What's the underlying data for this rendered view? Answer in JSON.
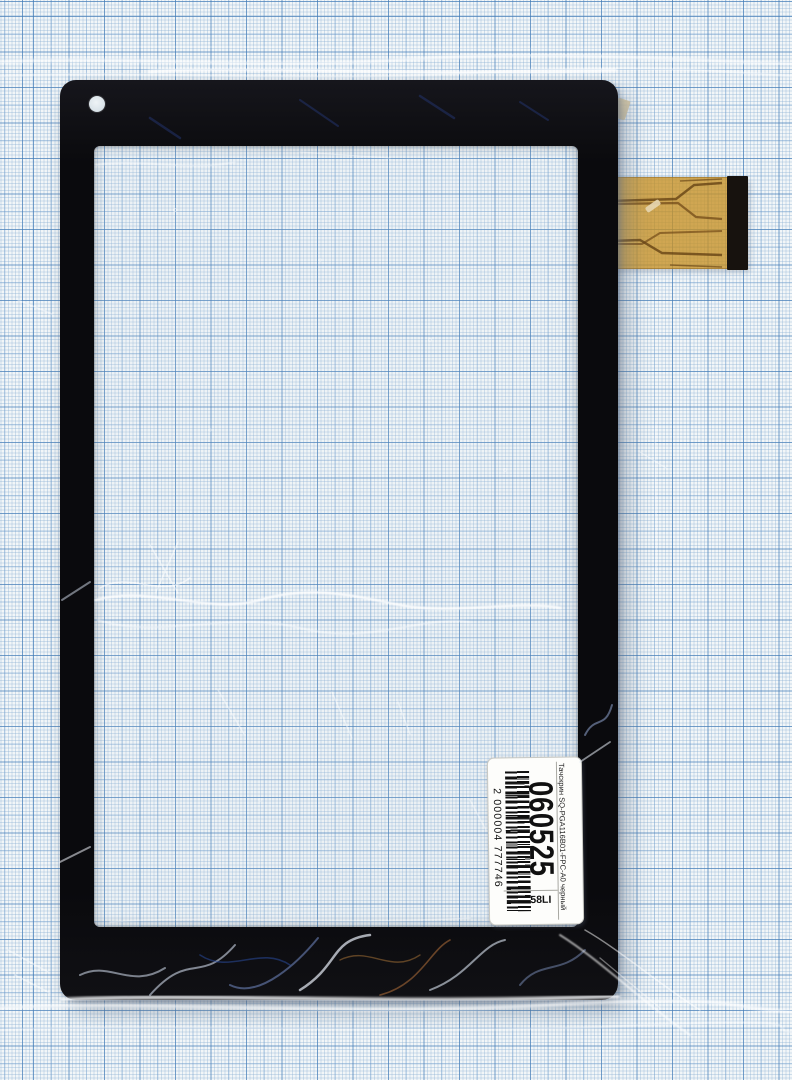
{
  "label": {
    "product_text": "Тачскрин SQ-PGA116B01-FPC-A0 черный",
    "sku": "060525",
    "batch": "58LI",
    "barcode_digits": "2 000004 777746"
  },
  "colors": {
    "paper": "#f2f6f8",
    "grid_major": "#3e78b4",
    "grid_fine": "#80a8d0",
    "bezel_black": "#0a0a0d",
    "flex_cable_orange": "#c79228",
    "stiffener_black": "#17120e",
    "label_background": "#fdfdfb",
    "label_ink": "#101010"
  }
}
